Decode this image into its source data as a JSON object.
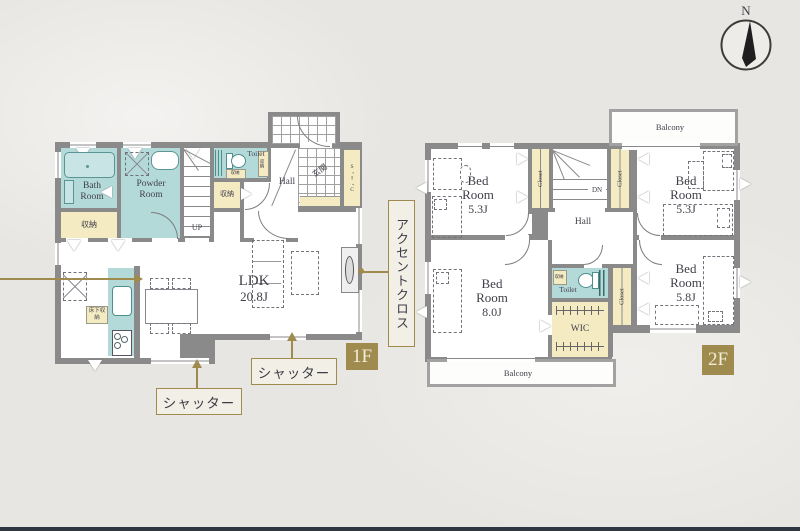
{
  "compass": {
    "label": "N"
  },
  "colors": {
    "teal": "#b4d9d9",
    "cream": "#f4ebc3",
    "gold": "#9f8b4e",
    "wall": "#8a8a8a"
  },
  "floor1": {
    "badge": "1F",
    "bath": "Bath Room",
    "storage": "収納",
    "powder": "Powder Room",
    "up": "UP",
    "toilet": "Toilet",
    "toilet_storage": "収納",
    "hall": "Hall",
    "entrance": "玄関",
    "sic": "S・I・C",
    "ldk_name": "LDK",
    "ldk_size": "20.8J",
    "underfloor_storage": "床下収納",
    "shutter": "シャッター",
    "accent_cloth": "アクセントクロス"
  },
  "floor2": {
    "badge": "2F",
    "bed": "Bed Room",
    "bed1_size": "5.3J",
    "bed2_size": "5.3J",
    "bed3_size": "8.0J",
    "bed4_size": "5.8J",
    "closet": "Closet",
    "dn": "DN",
    "hall": "Hall",
    "toilet": "Toilet",
    "toilet_storage": "収納",
    "wic": "WIC",
    "balcony": "Balcony"
  }
}
